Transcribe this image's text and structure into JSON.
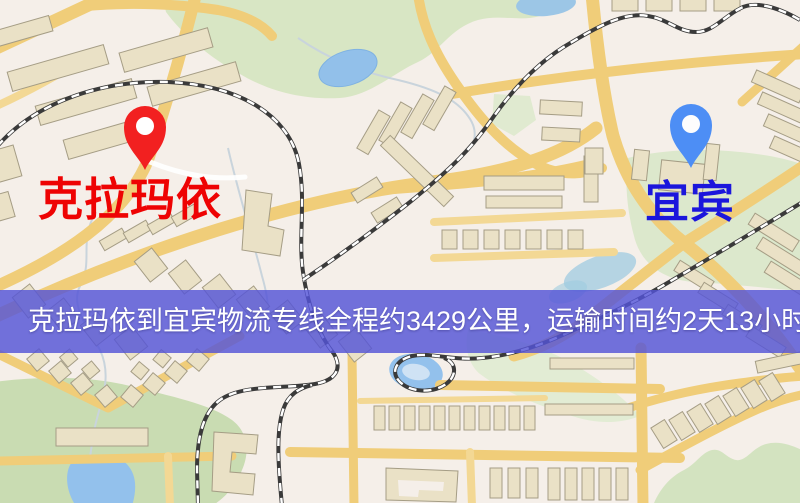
{
  "page": {
    "width": 800,
    "height": 503
  },
  "map": {
    "origin": {
      "label": "克拉玛依",
      "pin_icon": "red-map-pin",
      "pin_color": "#f22020",
      "label_color": "#ee0303"
    },
    "destination": {
      "label": "宜宾",
      "pin_icon": "blue-map-pin",
      "pin_color": "#4d8ef5",
      "label_color": "#1b16dc"
    },
    "palette": {
      "background": "#f5efe9",
      "road": "#f0cd79",
      "building": "#eae1c6",
      "park": "#d8e6c4",
      "water": "#93c1ec",
      "railway": "#3a3a3a"
    }
  },
  "banner": {
    "text": "克拉玛依到宜宾物流专线全程约3429公里，运输时间约2天13小时.",
    "origin": "克拉玛依",
    "destination": "宜宾",
    "distance_text": "约3429公里",
    "duration_text": "约2天13小时",
    "background_color": "#5454d7",
    "text_color": "#ffffff"
  }
}
